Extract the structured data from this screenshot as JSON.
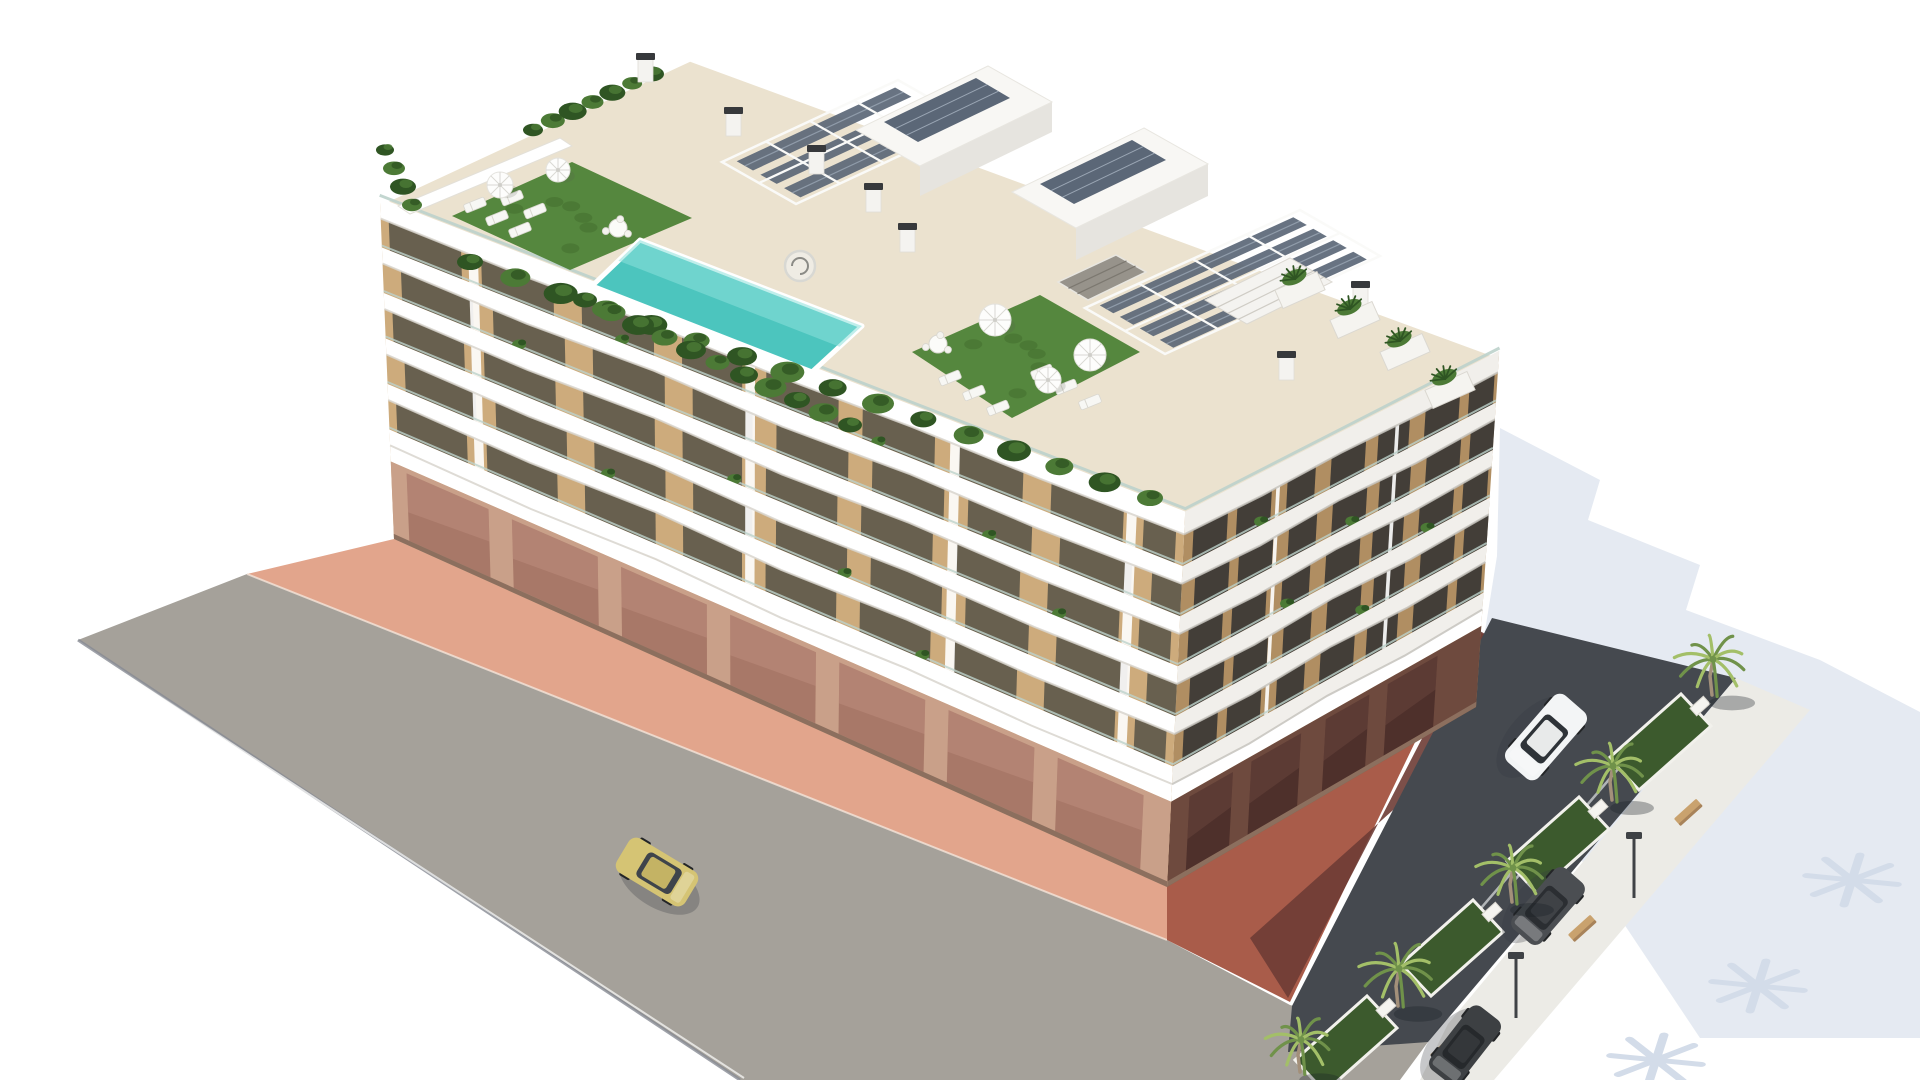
{
  "image": {
    "kind": "3d-architectural-rendering",
    "description": "Aerial 3D rendering of a modern white apartment building with wavy balcony bands, rooftop terrace with swimming pool, artificial turf, pergolas with solar panels, street with a yellow car, and a palm-lined parking area with a white SUV and dark cars"
  },
  "colors": {
    "background": "#ffffff",
    "shadow_pale": "#e5eaf2",
    "shadow_burst": "#d3dce9",
    "road": "#a5a19a",
    "road_curb": "#878b94",
    "sidewalk_pink": "#e2a58c",
    "sidewalk_line": "#f4e3d8",
    "red_light": "#a95c4a",
    "red_dark": "#6e3c35",
    "asphalt": "#45494f",
    "bay_line": "#d5d8da",
    "walk_light": "#ecebe6",
    "island_green": "#3c5a2d",
    "island_curb": "#f2f1ec",
    "palm_light": "#a3bf68",
    "palm_dark": "#70924a",
    "palm_trunk": "#a3907a",
    "palm_ground_shadow": "rgba(25,30,38,0.32)",
    "bench_wood": "#c9a26e",
    "bench_side": "#a8835a",
    "lamp_dark": "#3f4246",
    "deck_cream": "#ebe2cf",
    "turf_green": "#55873e",
    "turf_dark": "#416b2c",
    "pool_water": "#4cc5be",
    "pool_light": "#8ce0da",
    "plant_green": "#4c7a36",
    "plant_dark": "#2f5523",
    "white": "#ffffff",
    "facade_tan": "#cdab7c",
    "glass_dark": "#68604f",
    "band_white": "#ffffff",
    "band_shadow": "#d8d5ce",
    "rail_glass": "#bdd2cb",
    "facade_tan_R": "#b08e62",
    "glass_dark_R": "#433e38",
    "band_white_R": "#f1efeb",
    "band_shadow_R": "#c6c3bd",
    "ground_base": "#c9a089",
    "ground_glass": "#a87868",
    "ground_glass_hi": "#c09181",
    "ground_pillar": "#e8dcc6",
    "ground_dark": "#8c6f5e",
    "ground_base_R": "#6e4a3e",
    "ground_glass_R": "#4e302b",
    "pergola_frame": "#fafaf8",
    "panel_blue": "#5b6777",
    "panel_line": "#9aa6b4",
    "penthouse_top": "#f8f7f4",
    "penthouse_side": "#e6e4df",
    "chimney_white": "#f4f3f0",
    "chimney_cap": "#37393c",
    "umbrella_white": "#fdfdfc",
    "umbrella_rib": "#d9d8d3",
    "lounger_white": "#f7f7f4",
    "table_white": "#fbfbf9",
    "stair_gray": "#97938b"
  },
  "scene": {
    "building": {
      "floors": 5,
      "roof": {
        "left": [
          380,
          202
        ],
        "back": [
          690,
          58
        ],
        "right": [
          1499,
          355
        ],
        "front": [
          1185,
          516
        ]
      },
      "base": {
        "left": [
          394,
          539
        ],
        "front": [
          1167,
          887
        ],
        "right": [
          1476,
          707
        ]
      }
    },
    "roof_items": {
      "pool": [
        [
          640,
          240
        ],
        [
          862,
          326
        ],
        [
          812,
          372
        ],
        [
          592,
          286
        ]
      ],
      "turf1": [
        [
          452,
          216
        ],
        [
          572,
          162
        ],
        [
          692,
          218
        ],
        [
          570,
          270
        ]
      ],
      "turf2": [
        [
          912,
          352
        ],
        [
          1040,
          295
        ],
        [
          1140,
          352
        ],
        [
          1012,
          418
        ]
      ],
      "umbrellas": [
        [
          500,
          185,
          13
        ],
        [
          558,
          170,
          12
        ],
        [
          995,
          320,
          16
        ],
        [
          1090,
          355,
          16
        ],
        [
          1048,
          380,
          13
        ]
      ],
      "loungers": [
        [
          475,
          205
        ],
        [
          497,
          218
        ],
        [
          520,
          230
        ],
        [
          512,
          198
        ],
        [
          535,
          211
        ],
        [
          950,
          378
        ],
        [
          974,
          393
        ],
        [
          998,
          408
        ],
        [
          1042,
          372
        ],
        [
          1066,
          387
        ],
        [
          1090,
          402
        ]
      ],
      "tables": [
        [
          618,
          228
        ],
        [
          938,
          344
        ]
      ],
      "pergolaA": [
        [
          722,
          162
        ],
        [
          898,
          80
        ],
        [
          972,
          122
        ],
        [
          796,
          204
        ]
      ],
      "pergolaB": [
        [
          1085,
          308
        ],
        [
          1300,
          210
        ],
        [
          1380,
          256
        ],
        [
          1165,
          354
        ]
      ],
      "bar": [
        [
          1205,
          300
        ],
        [
          1290,
          258
        ],
        [
          1332,
          282
        ],
        [
          1247,
          324
        ]
      ],
      "penthouse1": {
        "top": [
          [
            856,
            130
          ],
          [
            988,
            66
          ],
          [
            1052,
            102
          ],
          [
            920,
            166
          ]
        ],
        "side": [
          [
            920,
            166
          ],
          [
            1052,
            102
          ],
          [
            1052,
            132
          ],
          [
            920,
            196
          ]
        ],
        "panel": [
          [
            884,
            122
          ],
          [
            976,
            78
          ],
          [
            1010,
            98
          ],
          [
            918,
            142
          ]
        ]
      },
      "penthouse2": {
        "top": [
          [
            1012,
            192
          ],
          [
            1144,
            128
          ],
          [
            1208,
            164
          ],
          [
            1076,
            228
          ]
        ],
        "side": [
          [
            1076,
            228
          ],
          [
            1208,
            164
          ],
          [
            1208,
            196
          ],
          [
            1076,
            260
          ]
        ],
        "panel": [
          [
            1040,
            184
          ],
          [
            1132,
            140
          ],
          [
            1166,
            160
          ],
          [
            1074,
            204
          ]
        ]
      },
      "chimneys": [
        [
          645,
          58
        ],
        [
          733,
          112
        ],
        [
          816,
          150
        ],
        [
          873,
          188
        ],
        [
          907,
          228
        ],
        [
          1286,
          356
        ],
        [
          1360,
          286
        ]
      ],
      "planter_boxes": [
        [
          1300,
          290
        ],
        [
          1355,
          320
        ],
        [
          1405,
          352
        ],
        [
          1450,
          390
        ]
      ],
      "spiral_stair": [
        800,
        266,
        15
      ],
      "stair_opening": [
        [
          1058,
          282
        ],
        [
          1116,
          255
        ],
        [
          1146,
          272
        ],
        [
          1088,
          300
        ]
      ],
      "back_wall": [
        [
          398,
          206
        ],
        [
          560,
          138
        ],
        [
          572,
          146
        ],
        [
          410,
          214
        ]
      ],
      "wall_plants": {
        "from": [
          533,
          130
        ],
        "to": [
          652,
          74
        ],
        "n": 7,
        "r": 10
      },
      "corner_plants": {
        "from": [
          385,
          150
        ],
        "to": [
          412,
          205
        ],
        "n": 4,
        "r": 9
      },
      "front_planter": {
        "from": [
          470,
          262
        ],
        "to": [
          1150,
          498
        ],
        "n": 16,
        "r": 13
      },
      "pool_planter": {
        "from": [
          585,
          300
        ],
        "to": [
          850,
          425
        ],
        "n": 11,
        "r": 12
      }
    },
    "ground": {
      "road": [
        [
          78,
          640
        ],
        [
          247,
          574
        ],
        [
          1167,
          940
        ],
        [
          1290,
          1005
        ],
        [
          1428,
          1042
        ],
        [
          1400,
          1080
        ],
        [
          740,
          1080
        ]
      ],
      "road_edge": [
        [
          78,
          640
        ],
        [
          740,
          1080
        ]
      ],
      "sidewalk": [
        [
          247,
          574
        ],
        [
          394,
          539
        ],
        [
          1167,
          885
        ],
        [
          1167,
          940
        ]
      ],
      "red_pavement": [
        [
          1167,
          885
        ],
        [
          1476,
          707
        ],
        [
          1540,
          660
        ],
        [
          1470,
          628
        ],
        [
          1290,
          1002
        ],
        [
          1167,
          940
        ]
      ],
      "red_dark": [
        [
          1250,
          938
        ],
        [
          1440,
          768
        ],
        [
          1548,
          668
        ],
        [
          1478,
          630
        ],
        [
          1288,
          998
        ]
      ],
      "asphalt": [
        [
          1492,
          618
        ],
        [
          1736,
          678
        ],
        [
          1428,
          1042
        ],
        [
          1288,
          1052
        ],
        [
          1292,
          1006
        ]
      ],
      "walk_right": [
        [
          1736,
          678
        ],
        [
          1810,
          710
        ],
        [
          1494,
          1080
        ],
        [
          1420,
          1080
        ],
        [
          1448,
          1024
        ]
      ],
      "shadow": [
        [
          1500,
          428
        ],
        [
          1600,
          480
        ],
        [
          1588,
          520
        ],
        [
          1700,
          565
        ],
        [
          1686,
          610
        ],
        [
          1820,
          660
        ],
        [
          1920,
          712
        ],
        [
          1920,
          1038
        ],
        [
          1700,
          1038
        ],
        [
          1556,
          822
        ],
        [
          1473,
          706
        ],
        [
          1497,
          556
        ]
      ],
      "islands": [
        [
          1660,
          742
        ],
        [
          1558,
          845
        ],
        [
          1452,
          948
        ],
        [
          1346,
          1044
        ]
      ],
      "bay_lines": [
        [
          1600,
          790
        ],
        [
          1545,
          845
        ],
        [
          1488,
          900
        ]
      ],
      "palm_shadow_bursts": [
        [
          1852,
          880
        ],
        [
          1758,
          986
        ],
        [
          1656,
          1060
        ]
      ]
    },
    "vehicles": [
      {
        "name": "yellow-car",
        "cx": 657,
        "cy": 872,
        "angle": 31,
        "len": 80,
        "wid": 40,
        "body": "#d5c474",
        "roof": "#c4b364",
        "glass": "#3f444b"
      },
      {
        "name": "white-suv",
        "cx": 1546,
        "cy": 737,
        "angle": 131,
        "len": 88,
        "wid": 42,
        "body": "#f3f5f6",
        "roof": "#e8eaea",
        "glass": "#2e3338"
      },
      {
        "name": "dark-car",
        "cx": 1548,
        "cy": 906,
        "angle": 131,
        "len": 80,
        "wid": 38,
        "body": "#4b4e52",
        "roof": "#3f4246",
        "glass": "#2b2e32"
      },
      {
        "name": "dark-car",
        "cx": 1465,
        "cy": 1045,
        "angle": 128,
        "len": 80,
        "wid": 38,
        "body": "#3d4043",
        "roof": "#34373a",
        "glass": "#26292c"
      }
    ],
    "palms": [
      [
        1712,
        695,
        1.05
      ],
      [
        1612,
        800,
        1.0
      ],
      [
        1512,
        902,
        1.0
      ],
      [
        1398,
        1006,
        1.1
      ],
      [
        1300,
        1072,
        0.95
      ]
    ],
    "benches": [
      [
        1688,
        812
      ],
      [
        1582,
        928
      ],
      [
        1444,
        1048
      ]
    ],
    "lamps": [
      [
        1634,
        838
      ],
      [
        1516,
        958
      ]
    ]
  }
}
